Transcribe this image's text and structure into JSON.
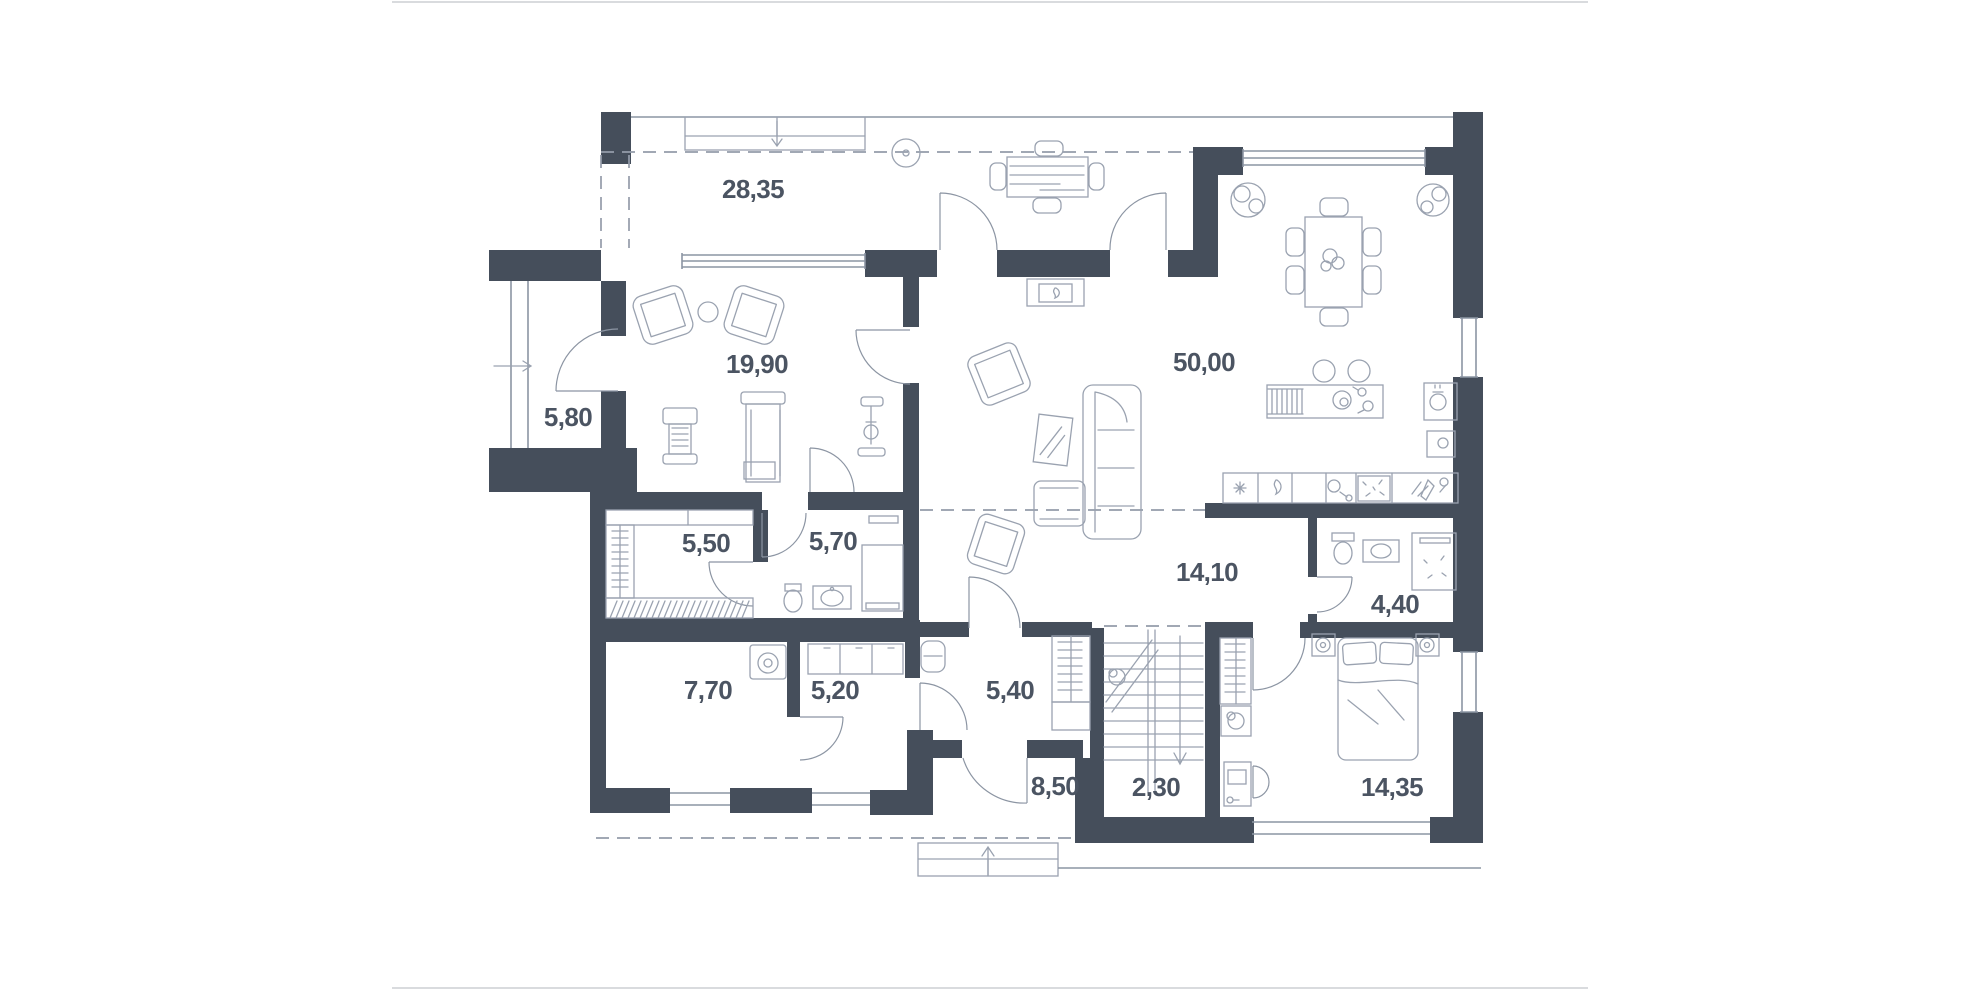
{
  "plan": {
    "title": "house-first-floor-plan",
    "colors": {
      "wall": "#454e5b",
      "line": "#9aa2b0",
      "win": "#8c95a3",
      "dash": "#949caa",
      "label": "#4b5462"
    },
    "rooms": [
      {
        "id": "terrace",
        "area": "28,35"
      },
      {
        "id": "gym-lounge",
        "area": "19,90"
      },
      {
        "id": "side-porch",
        "area": "5,80"
      },
      {
        "id": "kitchen-living",
        "area": "50,00"
      },
      {
        "id": "wardrobe-room",
        "area": "5,50"
      },
      {
        "id": "bathroom",
        "area": "5,70"
      },
      {
        "id": "hallway",
        "area": "14,10"
      },
      {
        "id": "wc",
        "area": "4,40"
      },
      {
        "id": "laundry-room",
        "area": "7,70"
      },
      {
        "id": "corridor",
        "area": "5,20"
      },
      {
        "id": "entry-hall",
        "area": "5,40"
      },
      {
        "id": "entrance-terrace",
        "area": "8,50"
      },
      {
        "id": "staircase",
        "area": "2,30"
      },
      {
        "id": "bedroom",
        "area": "14,35"
      }
    ],
    "icons": [
      "sideboard-icon",
      "ceiling-lamp-icon",
      "outdoor-table-icon",
      "dining-table-icon",
      "plant-icon",
      "fireplace-icon",
      "armchair-icon",
      "sofa-icon",
      "mirror-icon",
      "kitchen-island-icon",
      "bar-stool-icon",
      "counter-icon",
      "fridge-snowflake-icon",
      "hob-flame-icon",
      "sink-icon",
      "weight-machine-icon",
      "treadmill-icon",
      "exercise-bike-icon",
      "toilet-icon",
      "vanity-icon",
      "shower-icon",
      "washer-icon",
      "cabinet-icon",
      "bench-icon",
      "wardrobe-rail-icon",
      "stairs-icon",
      "bed-icon",
      "nightstand-lamp-icon",
      "desk-icon",
      "chair-icon",
      "entrance-arrow-icon"
    ]
  }
}
